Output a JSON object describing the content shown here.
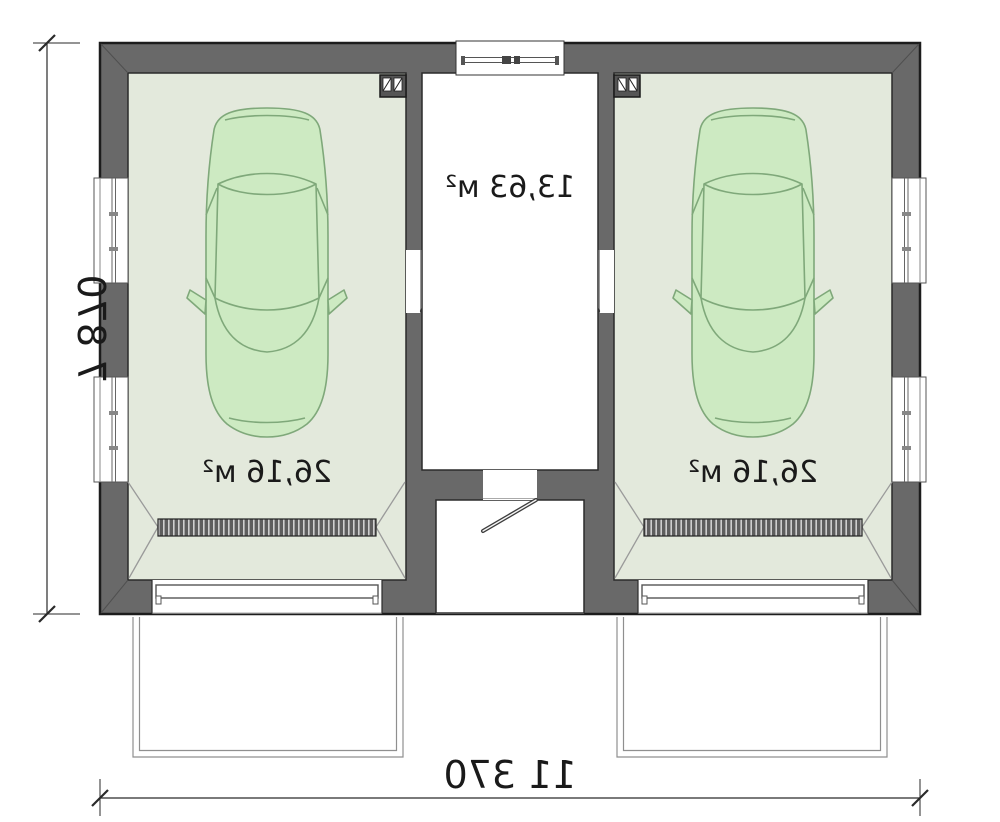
{
  "plan": {
    "title": "Double garage floor plan (mirrored drawing)",
    "mirrored_text": true,
    "rooms": [
      {
        "name": "left-garage",
        "area_label": "26,16 м²"
      },
      {
        "name": "central-room",
        "area_label": "13,63 м²"
      },
      {
        "name": "right-garage",
        "area_label": "26,16 м²"
      }
    ],
    "dimensions": {
      "overall_width_label": "11 370",
      "overall_depth_label": "7 870"
    },
    "features": [
      "car-top-view",
      "trench-drain-grate",
      "vent-duct-block",
      "entry-porch",
      "garage-doors",
      "driveway-aprons",
      "side-windows",
      "top-window"
    ],
    "colors": {
      "wall_fill": "#696969",
      "wall_outline": "#1c1c1c",
      "garage_floor": "#e3e9dc",
      "room_floor": "#ffffff",
      "car_fill": "#cdeac2",
      "car_stroke": "#7fa87a",
      "dimension_text": "#1a1a1a"
    }
  }
}
